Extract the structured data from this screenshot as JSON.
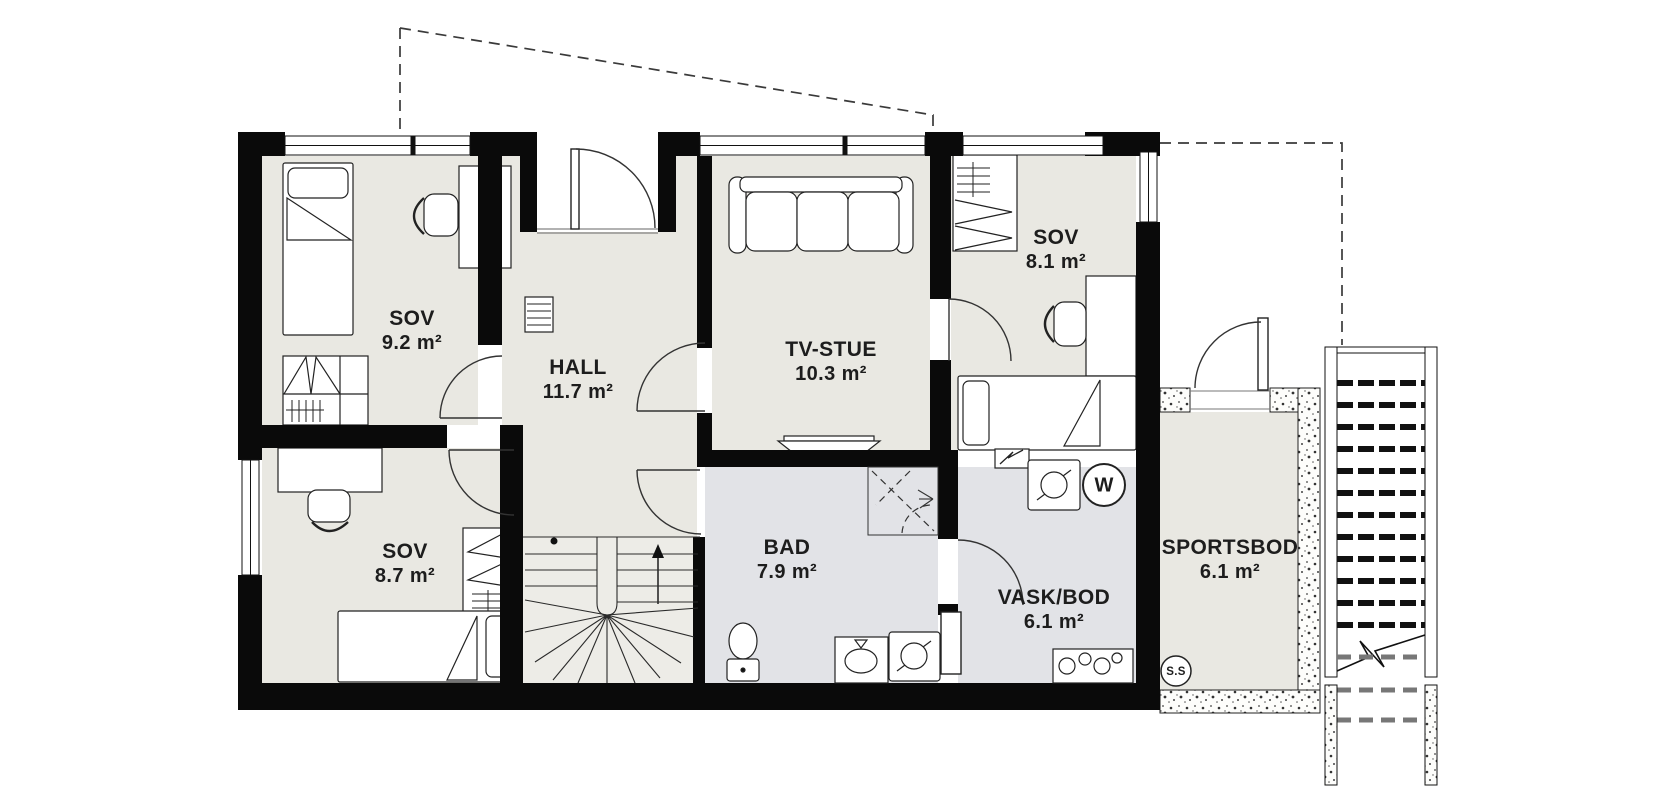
{
  "floor_plan": {
    "rooms": [
      {
        "key": "sov-1",
        "name": "SOV",
        "area": "9.2 m²"
      },
      {
        "key": "hall",
        "name": "HALL",
        "area": "11.7 m²"
      },
      {
        "key": "tv-stue",
        "name": "TV-STUE",
        "area": "10.3 m²"
      },
      {
        "key": "sov-2",
        "name": "SOV",
        "area": "8.1 m²"
      },
      {
        "key": "sov-3",
        "name": "SOV",
        "area": "8.7 m²"
      },
      {
        "key": "bad",
        "name": "BAD",
        "area": "7.9 m²"
      },
      {
        "key": "vask-bod",
        "name": "VASK/BOD",
        "area": "6.1 m²"
      },
      {
        "key": "sportsbod",
        "name": "SPORTSBOD",
        "area": "6.1 m²"
      }
    ],
    "markers": {
      "water_heater": "W",
      "ss_badge": "S.S"
    },
    "colors": {
      "wall": "#0a0a0a",
      "floor_dry": "#e9e8e2",
      "floor_wet": "#e2e3e7",
      "floor_stair": "#edece7",
      "line": "#222222"
    }
  }
}
